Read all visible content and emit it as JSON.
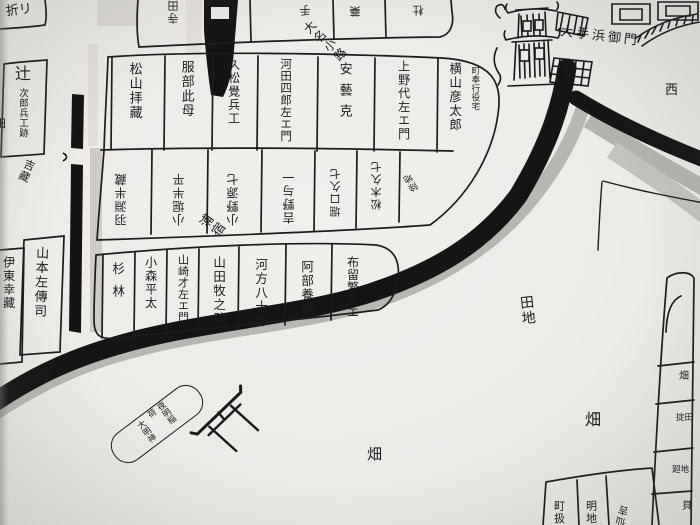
{
  "streets": {
    "daimyo_koji": "大名小路",
    "ura_juku": "浦宿"
  },
  "castle": {
    "gate_label": "大手浜御門",
    "direction_west": "西"
  },
  "notes": {
    "magistrate": "町奉行役宅",
    "corner_plot": "除地"
  },
  "shrine": {
    "name_col1": "夜明稲荷",
    "name_col2": "大明神"
  },
  "fields": {
    "denchi": "田地",
    "hata_right": "畑",
    "hata_bottom": "畑"
  },
  "plots": {
    "top_left_corner": "折リ",
    "tsuji_main": "辻",
    "tsuji_sub": "次郎兵工跡",
    "left_fragment": "田",
    "left_diagonal": "吉藏",
    "yamamoto": "山本左傳司",
    "ito": "伊東幸藏",
    "top_row": [
      "寺田",
      "手",
      "藥",
      "杜"
    ],
    "row1": [
      "松山拝藏",
      "服部此母",
      "久松覺兵工",
      "河田四郎左エ門",
      "安藝克",
      "上野代左エ門",
      "横山彦太郎"
    ],
    "row2": [
      "羽淵半藏",
      "小堀半平",
      "小野源七",
      "吉野与一",
      "堀口久七",
      "松木久七"
    ],
    "row3": [
      "杉林",
      "小森平太",
      "山崎才左エ門",
      "山田牧之助",
      "河方八十郎",
      "阿部養庵",
      "布留繁五エ"
    ],
    "right_strip": [
      "畑",
      "掟田",
      "廻地",
      "貝"
    ],
    "bottom_row": [
      "町扱",
      "明地",
      "仙吉"
    ]
  },
  "colors": {
    "ink": "#1c1c1c",
    "paper": "#eeecea",
    "wash": "#c7c5c1"
  }
}
